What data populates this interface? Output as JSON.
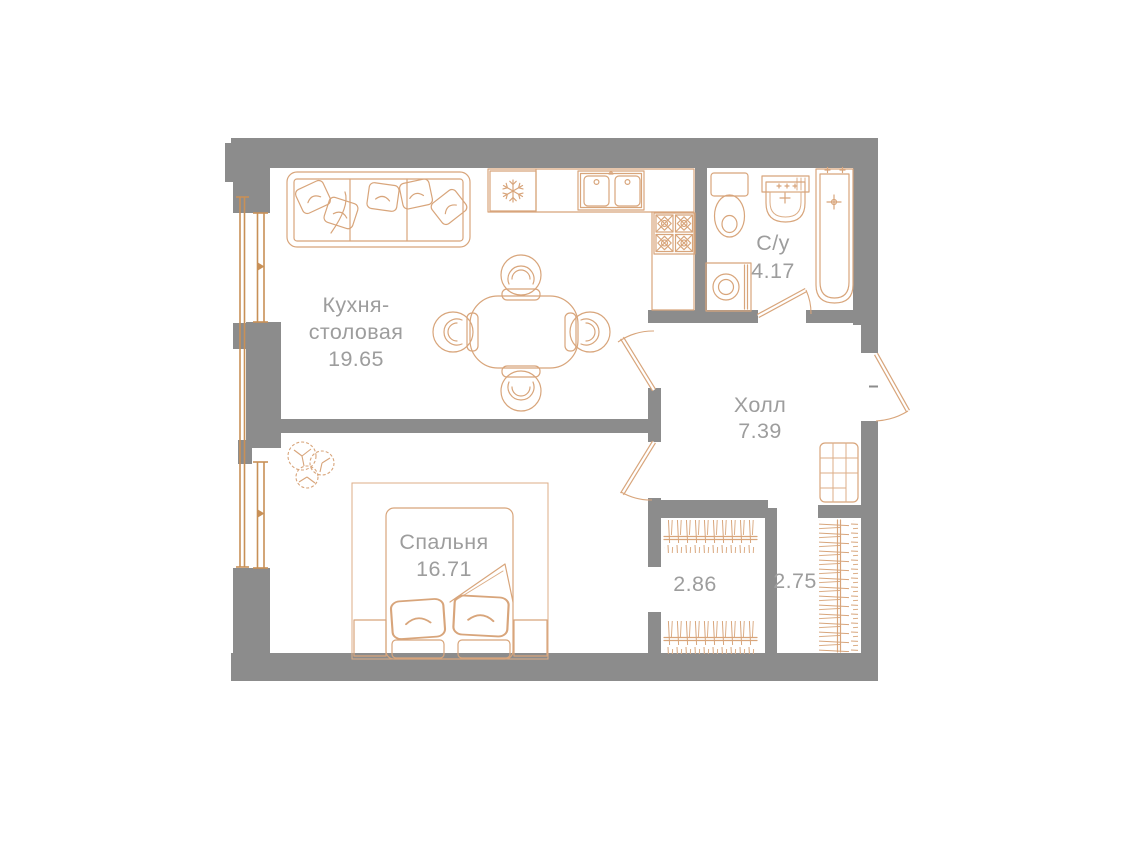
{
  "plan_title": "apartment-floor-plan",
  "colors": {
    "wall": "#8c8c8c",
    "furniture_line": "#d8a57b",
    "window_line": "#c89057",
    "label_text": "#9d9d9d",
    "background": "#ffffff"
  },
  "rooms": {
    "kitchen": {
      "name_line1": "Кухня-",
      "name_line2": "столовая",
      "area": "19.65"
    },
    "bedroom": {
      "name": "Спальня",
      "area": "16.71"
    },
    "hall": {
      "name": "Холл",
      "area": "7.39"
    },
    "bathroom": {
      "name": "С/у",
      "area": "4.17"
    },
    "wardrobe_left": {
      "area": "2.86"
    },
    "wardrobe_right": {
      "area": "2.75"
    }
  }
}
